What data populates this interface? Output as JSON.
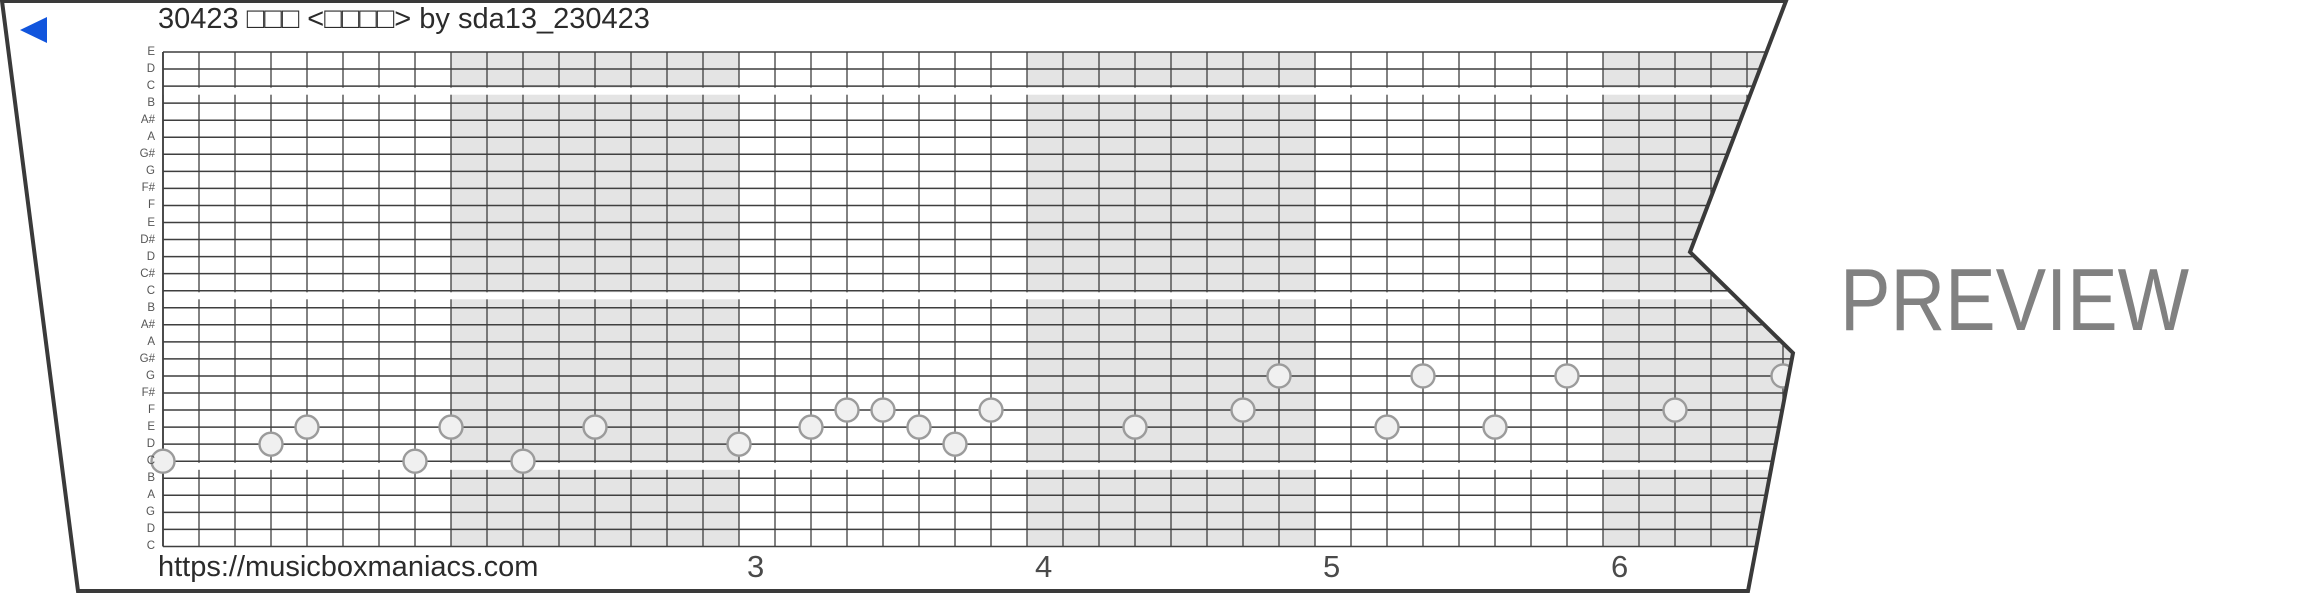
{
  "title": "30423 □□□ <□□□□> by sda13_230423",
  "url_text": "https://musicboxmaniacs.com",
  "preview_label": "PREVIEW",
  "colors": {
    "accent_blue": "#1155dd",
    "strip_border": "#3a3a3a",
    "grid_line": "#3f3f3f",
    "measure_shade": "#e4e4e4",
    "note_fill": "#f0f0f0",
    "note_stroke": "#9b9b9b",
    "watermark_gray": "#818181"
  },
  "chart_data": {
    "type": "music-box-strip",
    "row_labels_top_to_bottom": [
      "E",
      "D",
      "C",
      "B",
      "A#",
      "A",
      "G#",
      "G",
      "F#",
      "F",
      "E",
      "D#",
      "D",
      "C#",
      "C",
      "B",
      "A#",
      "A",
      "G#",
      "G",
      "F#",
      "F",
      "E",
      "D",
      "C",
      "B",
      "A",
      "G",
      "D",
      "C"
    ],
    "pitch_lines_top_to_bottom": [
      "E7",
      "D7",
      "C7",
      "B6",
      "A#6",
      "A6",
      "G#6",
      "G6",
      "F#6",
      "F6",
      "E6",
      "D#6",
      "D6",
      "C#6",
      "C6",
      "B5",
      "A#5",
      "A5",
      "G#5",
      "G5",
      "F#5",
      "F5",
      "E5",
      "D5",
      "C5",
      "B4",
      "A4",
      "G4",
      "D4",
      "C4"
    ],
    "octave_separator_after_rows": [
      2,
      14,
      24
    ],
    "cols_per_measure": 8,
    "total_cols": 48,
    "shaded_measure_start_cols": [
      8,
      24,
      40
    ],
    "measure_numbers": [
      {
        "label": "3",
        "col": 16
      },
      {
        "label": "4",
        "col": 24
      },
      {
        "label": "5",
        "col": 32
      },
      {
        "label": "6",
        "col": 40
      }
    ],
    "notes": [
      {
        "col": 0,
        "pitch": "C5"
      },
      {
        "col": 3,
        "pitch": "D5"
      },
      {
        "col": 4,
        "pitch": "E5"
      },
      {
        "col": 7,
        "pitch": "C5"
      },
      {
        "col": 8,
        "pitch": "E5"
      },
      {
        "col": 10,
        "pitch": "C5"
      },
      {
        "col": 12,
        "pitch": "E5"
      },
      {
        "col": 16,
        "pitch": "D5"
      },
      {
        "col": 18,
        "pitch": "E5"
      },
      {
        "col": 19,
        "pitch": "F5"
      },
      {
        "col": 20,
        "pitch": "F5"
      },
      {
        "col": 21,
        "pitch": "E5"
      },
      {
        "col": 22,
        "pitch": "D5"
      },
      {
        "col": 23,
        "pitch": "F5"
      },
      {
        "col": 27,
        "pitch": "E5"
      },
      {
        "col": 30,
        "pitch": "F5"
      },
      {
        "col": 31,
        "pitch": "G5"
      },
      {
        "col": 34,
        "pitch": "E5"
      },
      {
        "col": 35,
        "pitch": "G5"
      },
      {
        "col": 37,
        "pitch": "E5"
      },
      {
        "col": 39,
        "pitch": "G5"
      },
      {
        "col": 42,
        "pitch": "F5"
      },
      {
        "col": 45,
        "pitch": "G5"
      }
    ]
  }
}
